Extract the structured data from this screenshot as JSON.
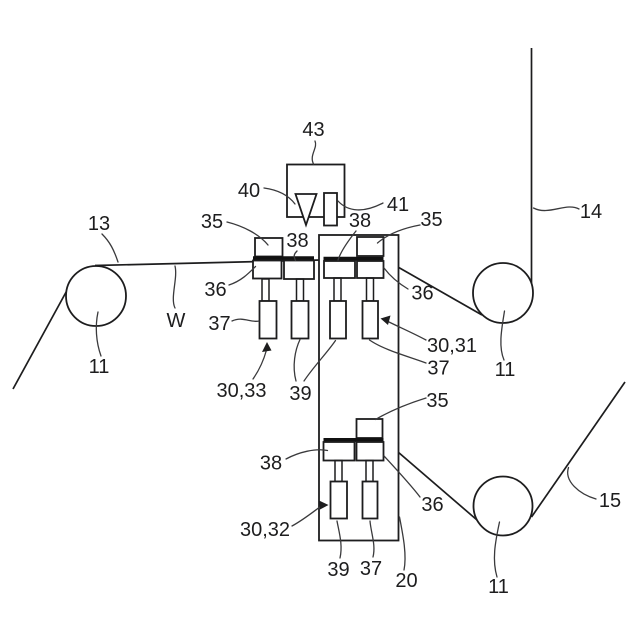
{
  "colors": {
    "ink": "#1d1d1e",
    "paper": "#ffffff"
  },
  "labels": {
    "hopper_box": "43",
    "funnel": "40",
    "nozzle": "41",
    "incoming_web_path": "13",
    "upper_left_roller": "11",
    "web": "W",
    "ul_top_clamp": "35",
    "ul_right_clamp": "38",
    "ul_left_clamp": "36",
    "ul_cylinder": "37",
    "ul_unit": "30,33",
    "upper_pins": "39",
    "ur_left_clamp": "38",
    "ur_top_clamp": "35",
    "ur_right_clamp": "36",
    "ur_unit": "30,31",
    "ur_cylinder": "37",
    "vertical_web_path": "14",
    "mid_right_roller": "11",
    "lower_top_clamp": "35",
    "lower_left_clamp": "38",
    "lower_right_clamp": "36",
    "lower_unit": "30,32",
    "lower_pin": "39",
    "lower_cylinder": "37",
    "frame": "20",
    "bottom_right_roller": "11",
    "outgoing_web_path": "15"
  }
}
